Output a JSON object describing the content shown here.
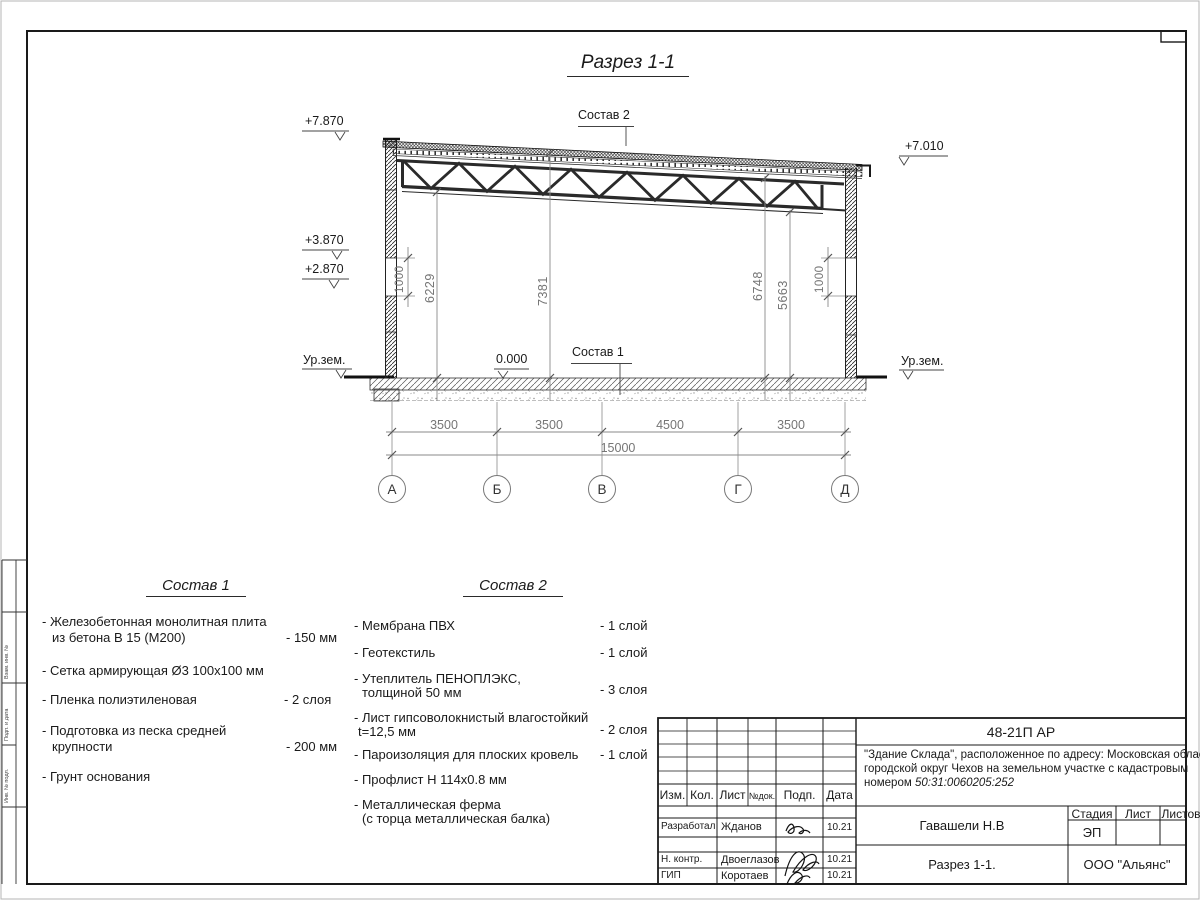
{
  "drawing_title": "Разрез 1-1",
  "labels": {
    "sostav1_ref": "Состав 1",
    "sostav2_ref": "Состав 2",
    "zero_level": "0.000",
    "ground_left": "Ур.зем.",
    "ground_right": "Ур.зем."
  },
  "elevations": {
    "top_left": "+7.870",
    "mid_left": "+3.870",
    "low_left": "+2.870",
    "top_right": "+7.010"
  },
  "vertical_dims": {
    "band_left": "1000",
    "h1": "6229",
    "h2": "7381",
    "h3": "6748",
    "h4": "5663",
    "band_right": "1000"
  },
  "axis_dims": [
    "3500",
    "3500",
    "4500",
    "3500"
  ],
  "total_dim": "15000",
  "axes": [
    "А",
    "Б",
    "В",
    "Г",
    "Д"
  ],
  "sostav1": {
    "title": "Состав 1",
    "items": [
      {
        "line1": "- Железобетонная  монолитная плита",
        "line2": "из бетона В 15 (М200)",
        "value": "- 150 мм"
      },
      {
        "line1": "- Сетка армирующая Ø3 100х100 мм"
      },
      {
        "line1": "- Пленка полиэтиленовая",
        "value": "-  2 слоя"
      },
      {
        "line1": "- Подготовка из песка средней",
        "line2": "крупности",
        "value": "- 200 мм"
      },
      {
        "line1": "- Грунт основания"
      }
    ]
  },
  "sostav2": {
    "title": "Состав 2",
    "items": [
      {
        "line1": "- Мембрана ПВХ",
        "value": "- 1 слой"
      },
      {
        "line1": "- Геотекстиль",
        "value": "- 1 слой"
      },
      {
        "line1": "- Утеплитель ПЕНОПЛЭКС,",
        "line2": "толщиной 50 мм",
        "value": "- 3 слоя"
      },
      {
        "line1": "- Лист гипсоволокнистый влагостойкий",
        "line2": "t=12,5 мм",
        "value": "- 2 слоя"
      },
      {
        "line1": "- Пароизоляция для плоских кровель",
        "value": "- 1 слой"
      },
      {
        "line1": "- Профлист Н 114х0.8 мм"
      },
      {
        "line1": "- Металлическая ферма",
        "line2": "(с торца металлическая балка)"
      }
    ]
  },
  "titleblock": {
    "doc_number": "48-21П АР",
    "description_line1": "\"Здание Склада\", расположенное по адресу: Московская область,",
    "description_line2": "городской округ Чехов на земельном участке с кадастровым",
    "description_line3_prefix": "номером ",
    "cadastral_number": "50:31:0060205:252",
    "header": {
      "izm": "Изм.",
      "kol": "Кол.",
      "list": "Лист",
      "ndok": "№док.",
      "podp": "Подп.",
      "data": "Дата"
    },
    "rows": [
      {
        "role": "Разработал",
        "name": "Жданов",
        "date": "10.21"
      },
      {
        "role": "Н. контр.",
        "name": "Двоеглазов",
        "date": "10.21"
      },
      {
        "role": "ГИП",
        "name": "Коротаев",
        "date": "10.21"
      }
    ],
    "chief": "Гавашели Н.В",
    "sheet_title": "Разрез 1-1.",
    "stage_label": "Стадия",
    "sheet_label": "Лист",
    "sheets_label": "Листов",
    "stage_value": "ЭП",
    "company": "ООО \"Альянс\""
  },
  "side_stamp": {
    "cells": [
      "Взам. инв. №",
      "Подп. и дата",
      "Инв. № подл."
    ]
  }
}
